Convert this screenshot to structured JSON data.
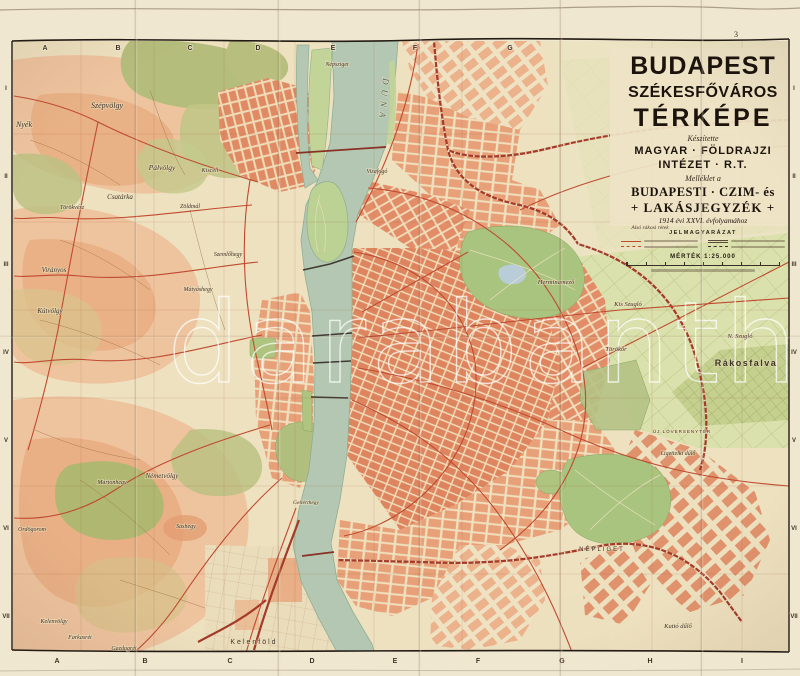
{
  "watermark": "darabanth",
  "title_block": {
    "line1": "BUDAPEST",
    "line2": "SZÉKESFŐVÁROS",
    "line3": "TÉRKÉPE",
    "made_by": "Készítette",
    "publisher_line1": "MAGYAR · FÖLDRAJZI",
    "publisher_line2": "INTÉZET · R.T.",
    "supplement_intro": "Melléklet a",
    "supplement_line1": "BUDAPESTI · CZIM- és",
    "supplement_line2": "+ LAKÁSJEGYZÉK +",
    "supplement_line3": "1914 évi XXVI. évfolyamához",
    "legend_title": "JELMAGYARÁZAT",
    "scale_label": "MÉRTÉK 1:25.000"
  },
  "grid": {
    "sheet_number": "3",
    "top_letters": [
      {
        "t": "A",
        "x": 45
      },
      {
        "t": "B",
        "x": 118
      },
      {
        "t": "C",
        "x": 190
      },
      {
        "t": "D",
        "x": 258
      },
      {
        "t": "E",
        "x": 333
      },
      {
        "t": "F",
        "x": 415
      },
      {
        "t": "G",
        "x": 510
      }
    ],
    "bottom_letters": [
      {
        "t": "A",
        "x": 57
      },
      {
        "t": "B",
        "x": 145
      },
      {
        "t": "C",
        "x": 230
      },
      {
        "t": "D",
        "x": 312
      },
      {
        "t": "E",
        "x": 395
      },
      {
        "t": "F",
        "x": 478
      },
      {
        "t": "G",
        "x": 562
      },
      {
        "t": "H",
        "x": 650
      },
      {
        "t": "I",
        "x": 742
      }
    ],
    "left_numerals": [
      {
        "t": "I",
        "y": 90
      },
      {
        "t": "II",
        "y": 178
      },
      {
        "t": "III",
        "y": 266
      },
      {
        "t": "IV",
        "y": 354
      },
      {
        "t": "V",
        "y": 442
      },
      {
        "t": "VI",
        "y": 530
      },
      {
        "t": "VII",
        "y": 618
      }
    ],
    "right_numerals": [
      {
        "t": "I",
        "y": 90
      },
      {
        "t": "II",
        "y": 178
      },
      {
        "t": "III",
        "y": 266
      },
      {
        "t": "IV",
        "y": 354
      },
      {
        "t": "V",
        "y": 442
      },
      {
        "t": "VI",
        "y": 530
      },
      {
        "t": "VII",
        "y": 618
      }
    ]
  },
  "labels": [
    {
      "t": "Szépvölgy",
      "x": 107,
      "y": 108,
      "fs": 8,
      "it": true
    },
    {
      "t": "Nyék",
      "x": 24,
      "y": 127,
      "fs": 8,
      "it": true
    },
    {
      "t": "Pálvölgy",
      "x": 162,
      "y": 170,
      "fs": 7.5,
      "it": true
    },
    {
      "t": "Kiscell",
      "x": 210,
      "y": 172,
      "fs": 6,
      "it": true
    },
    {
      "t": "Zöldmál",
      "x": 190,
      "y": 208,
      "fs": 6,
      "it": true
    },
    {
      "t": "Csatárka",
      "x": 120,
      "y": 199,
      "fs": 7,
      "it": true
    },
    {
      "t": "Törökvész",
      "x": 72,
      "y": 209,
      "fs": 6,
      "it": true
    },
    {
      "t": "Szemlőhegy",
      "x": 228,
      "y": 256,
      "fs": 6,
      "it": true
    },
    {
      "t": "Mátyáshegy",
      "x": 198,
      "y": 291,
      "fs": 6,
      "it": true
    },
    {
      "t": "Virányos",
      "x": 54,
      "y": 272,
      "fs": 7,
      "it": true
    },
    {
      "t": "Kútvölgy",
      "x": 50,
      "y": 313,
      "fs": 7,
      "it": true
    },
    {
      "t": "Népsziget",
      "x": 337,
      "y": 66,
      "fs": 6,
      "it": true
    },
    {
      "t": "DUNA",
      "x": 381,
      "y": 100,
      "fs": 9,
      "sp": 5,
      "rot": 95,
      "col": "#55695b",
      "it": true
    },
    {
      "t": "Vizafogó",
      "x": 377,
      "y": 173,
      "fs": 6,
      "it": true
    },
    {
      "t": "Herminamező",
      "x": 556,
      "y": 284,
      "fs": 6.5,
      "it": true
    },
    {
      "t": "Kis Szugló",
      "x": 628,
      "y": 306,
      "fs": 6.5,
      "it": true
    },
    {
      "t": "N. Szugló",
      "x": 740,
      "y": 338,
      "fs": 6.5,
      "it": true
    },
    {
      "t": "Törökőr",
      "x": 616,
      "y": 351,
      "fs": 6.5,
      "it": true
    },
    {
      "t": "Rákosfalva",
      "x": 746,
      "y": 366,
      "fs": 9,
      "sp": 1.5,
      "w": 700
    },
    {
      "t": "Alsó rákosi rétek",
      "x": 650,
      "y": 229,
      "fs": 5.5,
      "it": true
    },
    {
      "t": "ÚJ LÓVERSENYTÉR",
      "x": 682,
      "y": 433,
      "fs": 4.5,
      "sp": 1
    },
    {
      "t": "Ligettelki dűlő",
      "x": 678,
      "y": 455,
      "fs": 6,
      "it": true
    },
    {
      "t": "NÉPLIGET",
      "x": 602,
      "y": 551,
      "fs": 6,
      "sp": 2
    },
    {
      "t": "Kuttó dűlő",
      "x": 678,
      "y": 628,
      "fs": 6.5,
      "it": true
    },
    {
      "t": "Gellérthegy",
      "x": 306,
      "y": 504,
      "fs": 5.5,
      "it": true
    },
    {
      "t": "Németvölgy",
      "x": 162,
      "y": 478,
      "fs": 7,
      "it": true
    },
    {
      "t": "Sashegy",
      "x": 186,
      "y": 528,
      "fs": 6,
      "it": true
    },
    {
      "t": "Ördögorom",
      "x": 32,
      "y": 531,
      "fs": 6,
      "it": true
    },
    {
      "t": "Mártonhegy",
      "x": 112,
      "y": 484,
      "fs": 6,
      "it": true
    },
    {
      "t": "Kelenvölgy",
      "x": 54,
      "y": 623,
      "fs": 6,
      "it": true
    },
    {
      "t": "Farkasrét",
      "x": 80,
      "y": 639,
      "fs": 6,
      "it": true
    },
    {
      "t": "Gazdagrét",
      "x": 124,
      "y": 650,
      "fs": 6,
      "it": true
    },
    {
      "t": "Kelenföld",
      "x": 254,
      "y": 644,
      "fs": 7,
      "sp": 2
    }
  ],
  "colors": {
    "paper": "#ecdfc0",
    "paper_margin": "#f0e7d1",
    "water": "#b4c7b2",
    "blocks_dense": "#de8560",
    "blocks_light": "#ecb28c",
    "terrain_salmon": "#eec49f",
    "forest_olive": "#b5bd7c",
    "fields_green": "#d9dfab",
    "park_green": "#a9c47e",
    "road_red": "#bf4a30",
    "rail_red": "#9e3528",
    "frame_ink": "#231c14",
    "label_ink": "#3f3327",
    "watermark": "#ffffff"
  }
}
